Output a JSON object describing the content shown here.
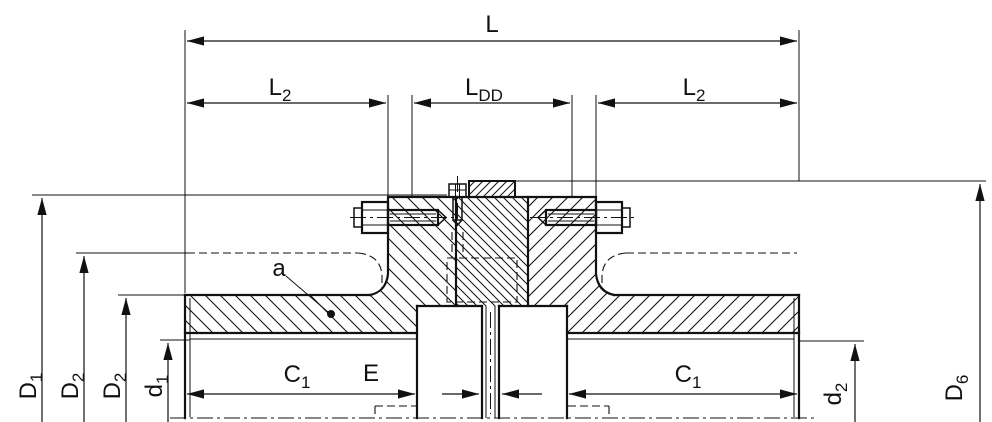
{
  "drawing": {
    "type": "technical-dimension-drawing",
    "subject": "flange shaft coupling cross-section",
    "colors": {
      "line": "#111111",
      "background": "#ffffff"
    },
    "dims": {
      "l": {
        "main": "L",
        "sub": ""
      },
      "l2_left": {
        "main": "L",
        "sub": "2"
      },
      "ldd": {
        "main": "L",
        "sub": "DD"
      },
      "l2_right": {
        "main": "L",
        "sub": "2"
      },
      "d1_big": {
        "main": "D",
        "sub": "1"
      },
      "d2_outer": {
        "main": "D",
        "sub": "2"
      },
      "d2_inner": {
        "main": "D",
        "sub": "2"
      },
      "d1_small": {
        "main": "d",
        "sub": "1"
      },
      "c1_left": {
        "main": "C",
        "sub": "1"
      },
      "e": {
        "main": "E",
        "sub": ""
      },
      "c1_right": {
        "main": "C",
        "sub": "1"
      },
      "d2_small": {
        "main": "d",
        "sub": "2"
      },
      "d6": {
        "main": "D",
        "sub": "6"
      }
    },
    "callouts": {
      "a": "a"
    }
  }
}
